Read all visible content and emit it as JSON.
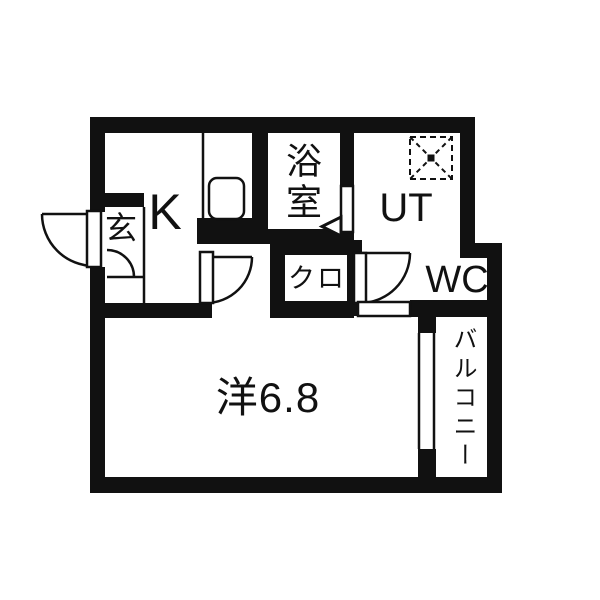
{
  "floorplan": {
    "title": "apartment-floorplan-1k",
    "ink_color": "#111111",
    "background_color": "#ffffff",
    "rooms": {
      "kitchen": {
        "label": "K"
      },
      "entrance": {
        "label": "玄"
      },
      "bathroom": {
        "label": "浴室"
      },
      "utility": {
        "label": "UT"
      },
      "closet": {
        "label": "クロ"
      },
      "toilet": {
        "label": "WC"
      },
      "main_room": {
        "label": "洋6.8"
      },
      "balcony": {
        "label": "バルコニー"
      }
    },
    "symbols": {
      "kitchen_sink": "rounded-rectangle sink in counter",
      "washing_machine_pan": "dashed square with X and center dot",
      "balcony_window": "double-line sliding window",
      "door_swings": "quarter-circle arcs at entrance, kitchen, WC",
      "bath_door": "panel with left-pointing triangle"
    }
  }
}
